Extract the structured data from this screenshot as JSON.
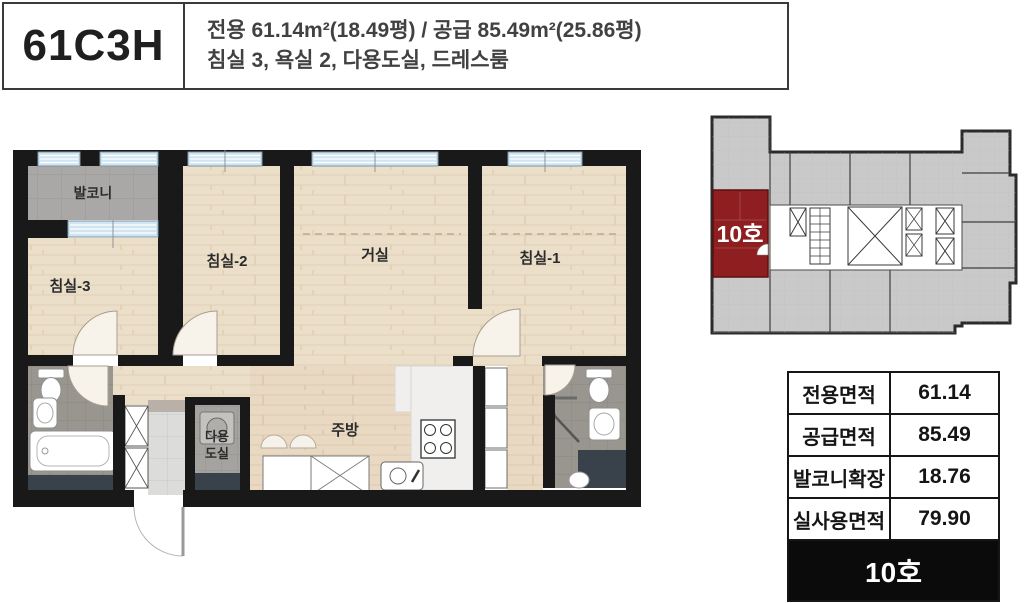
{
  "header": {
    "unit_code": "61C3H",
    "spec_line1": "전용 61.14m²(18.49평) / 공급 85.49m²(25.86평)",
    "spec_line2": "침실 3, 욕실 2, 다용도실, 드레스룸"
  },
  "floor_plan": {
    "labels": {
      "balcony": "발코니",
      "bedroom3": "침실-3",
      "bedroom2": "침실-2",
      "living": "거실",
      "bedroom1": "침실-1",
      "kitchen": "주방",
      "utility_line1": "다용",
      "utility_line2": "도실"
    }
  },
  "key_plan": {
    "unit_label": "10호",
    "highlight_color": "#8e1e1f"
  },
  "area_table": {
    "rows": [
      {
        "label": "전용면적",
        "value": "61.14"
      },
      {
        "label": "공급면적",
        "value": "85.49"
      },
      {
        "label": "발코니확장",
        "value": "18.76"
      },
      {
        "label": "실사용면적",
        "value": "79.90"
      }
    ],
    "footer": "10호"
  },
  "colors": {
    "wall": "#191919",
    "wood": "#ecdfc9",
    "window": "#d0e5f1",
    "bath_tile": "#99968f",
    "highlight_red": "#8e1e1f",
    "table_border": "#161616",
    "footer_bg": "#0b0b0b"
  }
}
